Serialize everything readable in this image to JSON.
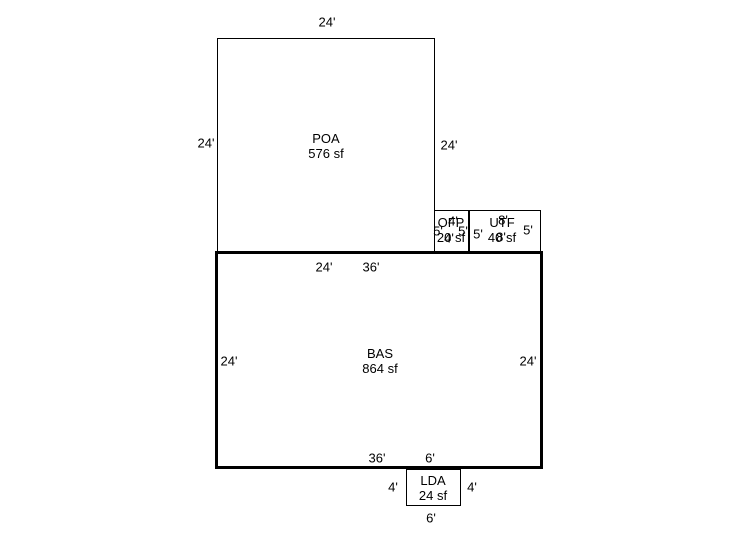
{
  "sketch": {
    "background_color": "#ffffff",
    "line_color": "#000000",
    "areas": {
      "poa": {
        "code": "POA",
        "area": "576 sf",
        "dim_top": "24'",
        "dim_left": "24'",
        "dim_right": "24'"
      },
      "ofp": {
        "code": "OFP",
        "area": "20 sf",
        "dim_top": "4'",
        "dim_bottom": "4'",
        "dim_left": "5'",
        "dim_right": "5'"
      },
      "utf": {
        "code": "UTF",
        "area": "40 sf",
        "dim_top": "8'",
        "dim_bottom": "8'",
        "dim_left": "5'",
        "dim_right": "5'"
      },
      "bas": {
        "code": "BAS",
        "area": "864 sf",
        "dim_top_seg1": "24'",
        "dim_top_seg2": "36'",
        "dim_left": "24'",
        "dim_right": "24'",
        "dim_bottom_seg1": "36'",
        "dim_bottom_seg2": "6'"
      },
      "lda": {
        "code": "LDA",
        "area": "24 sf",
        "dim_left": "4'",
        "dim_right": "4'",
        "dim_bottom": "6'"
      }
    }
  }
}
